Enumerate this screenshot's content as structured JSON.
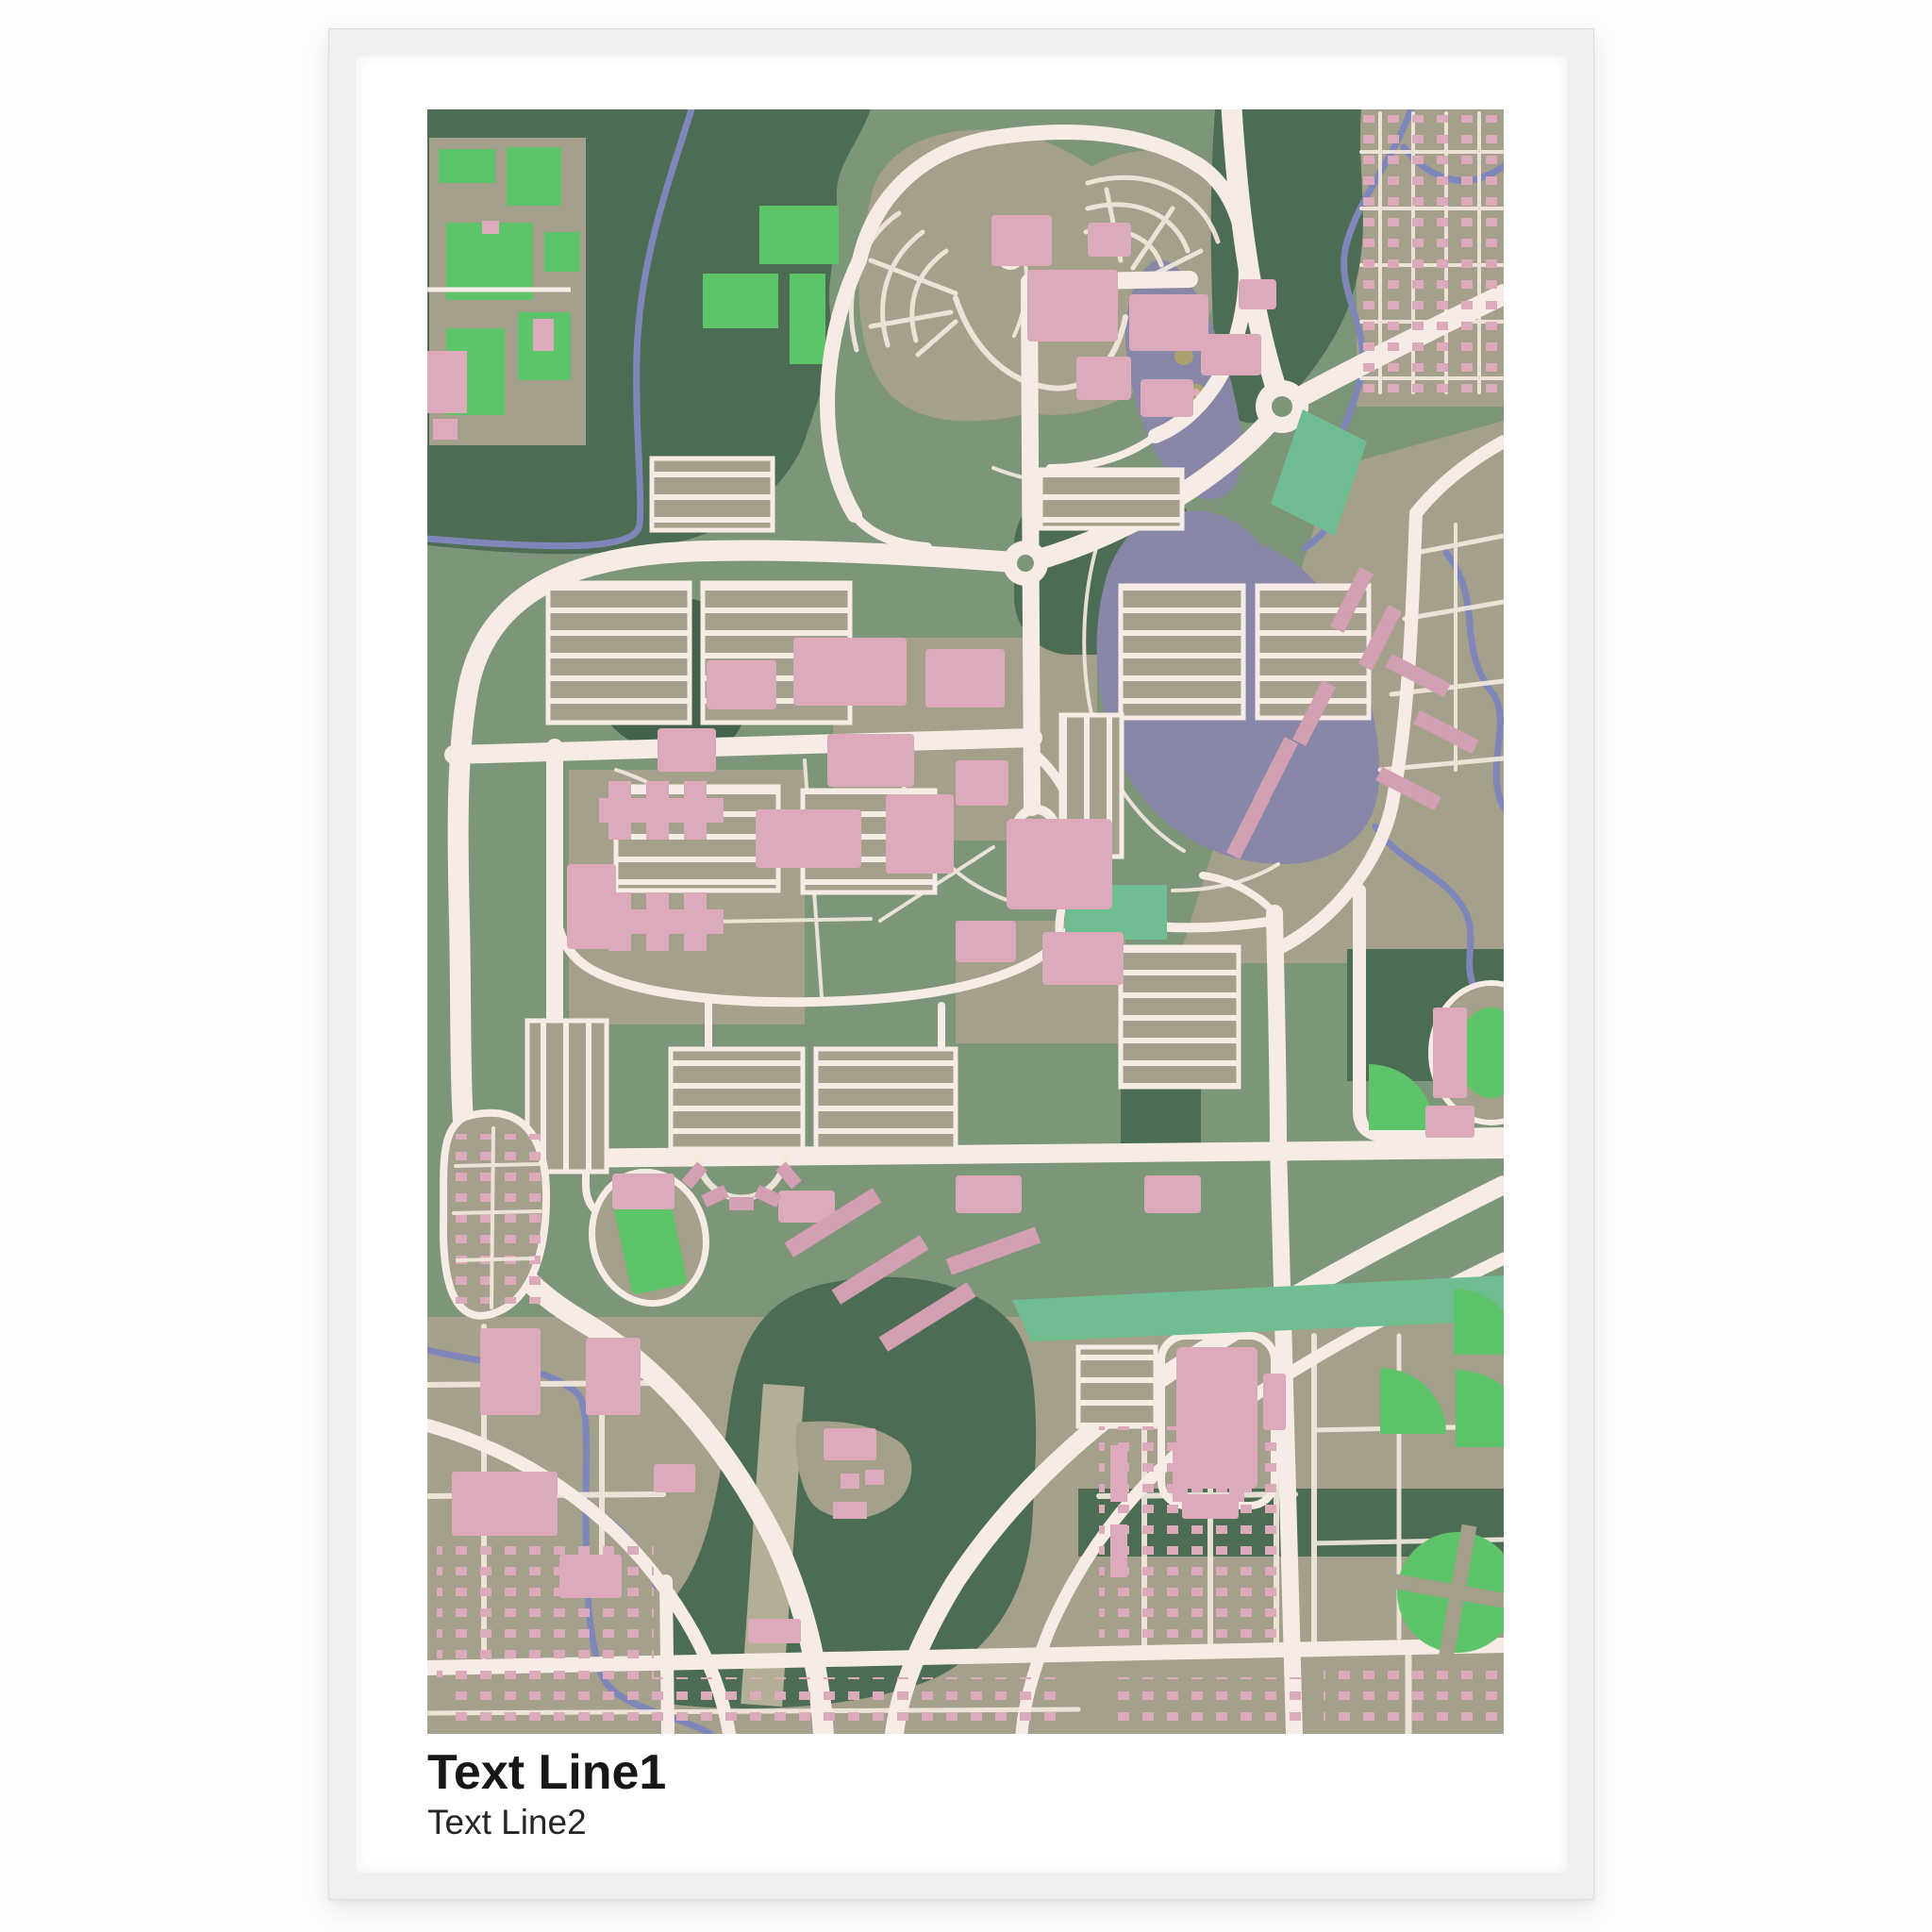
{
  "poster": {
    "title_line1": "Text Line1",
    "title_line2": "Text Line2"
  },
  "map": {
    "alt": "Stylized pastel street-map artwork of a campus town: green parks, olive city blocks, cream roads, a purple lake and rivers, pink buildings and bright-green sports fields"
  },
  "theme": {
    "page_bg": "#fdfdfd",
    "frame": "#eef0ef",
    "frame_edge": "#dcdfde",
    "paper": "#ffffff",
    "map_base": "#7d9679",
    "sage": "#a4a08b",
    "sage_light": "#b3af96",
    "dark_green": "#4c6d53",
    "darker_green": "#42634b",
    "bright_green": "#5ec46a",
    "teal_green": "#6fbd90",
    "lake": "#8987a7",
    "river": "#7f87ba",
    "road": "#f6ece5",
    "road_thin": "#f3e9dd",
    "building": "#dcaaba",
    "building_deep": "#d39fb2",
    "sand": "#a9a16e",
    "title_color": "#171717",
    "subtitle_color": "#262626"
  }
}
